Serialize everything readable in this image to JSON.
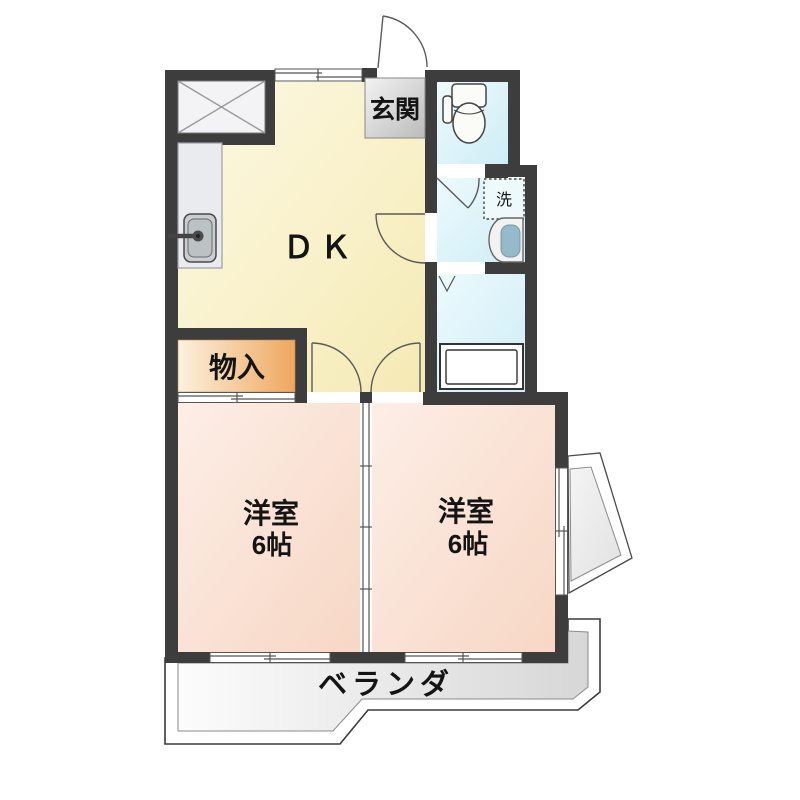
{
  "plan": {
    "rooms": {
      "dk": {
        "label": "ＤＫ"
      },
      "entrance": {
        "label": "玄関"
      },
      "storage": {
        "label": "物入"
      },
      "laundry": {
        "label": "洗"
      },
      "room1": {
        "label": "洋室",
        "size": "6帖"
      },
      "room2": {
        "label": "洋室",
        "size": "6帖"
      },
      "veranda": {
        "label": "ベランダ"
      }
    },
    "icons": {
      "toilet": "toilet-icon",
      "kitchen_sink": "kitchen-sink-icon",
      "wash_basin": "wash-basin-icon",
      "bathtub": "bathtub-icon",
      "washing_machine_space": "washing-machine-space",
      "crossed_box": "crossed-box-symbol",
      "door_swings": "door-swing-symbol",
      "sliding_windows": "sliding-window-symbol",
      "folding_door": "folding-door-symbol"
    },
    "colors": {
      "wall": "#3d3d3d",
      "dk_floor": "#f8efc4",
      "room_floor": "#fadfd0",
      "wet_area_floor": "#ddf3f9",
      "storage_fill": "#efa75f",
      "entrance_mat": "#cccccc",
      "veranda_floor": "#e2e2e2",
      "balcony_floor": "#ececec",
      "outline": "#3a3a3a"
    }
  }
}
